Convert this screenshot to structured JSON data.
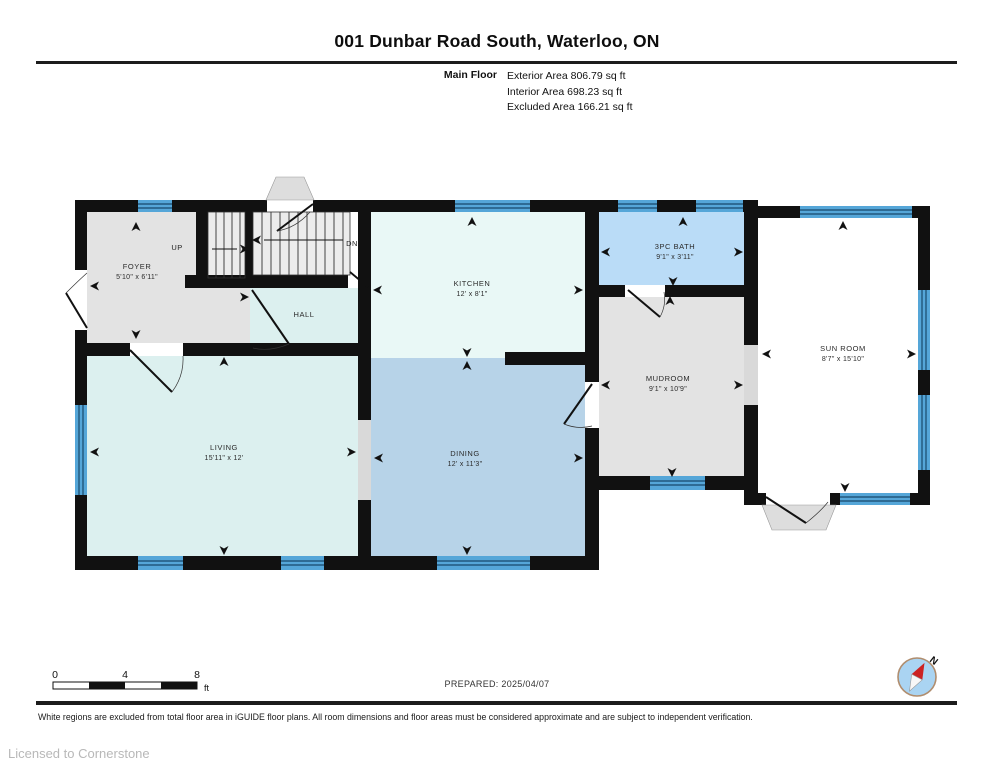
{
  "header": {
    "title": "001 Dunbar Road South, Waterloo, ON",
    "floor_label": "Main Floor",
    "area_lines": [
      "Exterior Area 806.79 sq ft",
      "Interior Area 698.23 sq ft",
      "Excluded Area 166.21 sq ft"
    ]
  },
  "rooms": {
    "foyer": {
      "name": "FOYER",
      "dims": "5'10\" x 6'11\""
    },
    "hall": {
      "name": "HALL",
      "dims": ""
    },
    "kitchen": {
      "name": "KITCHEN",
      "dims": "12' x 8'1\""
    },
    "bath": {
      "name": "3PC BATH",
      "dims": "9'1\" x 3'11\""
    },
    "mudroom": {
      "name": "MUDROOM",
      "dims": "9'1\" x 10'9\""
    },
    "sunroom": {
      "name": "SUN ROOM",
      "dims": "8'7\" x 15'10\""
    },
    "living": {
      "name": "LIVING",
      "dims": "15'11\" x 12'"
    },
    "dining": {
      "name": "DINING",
      "dims": "12' x 11'3\""
    }
  },
  "stairs": {
    "up_label": "UP",
    "down_label": "DN"
  },
  "scale_bar": {
    "tick_0": "0",
    "tick_4": "4",
    "tick_8": "8",
    "unit": "ft"
  },
  "compass": {
    "north_label": "N"
  },
  "footer": {
    "prepared": "PREPARED: 2025/04/07",
    "disclaimer": "White regions are excluded from total floor area in iGUIDE floor plans. All room dimensions and floor areas must be considered approximate and are subject to independent verification.",
    "license": "Licensed to Cornerstone"
  },
  "colors": {
    "wall": "#111111",
    "window_blue": "#55a6d8",
    "window_line": "#17486b",
    "room_gray": "#e3e3e3",
    "room_pale_cyan": "#dcf0ef",
    "room_light_cyan": "#e9f8f6",
    "room_bath_blue": "#badcf7",
    "room_dining_blue": "#b7d3e8",
    "stair_gray": "#ececec",
    "open_gray": "#d9d9d9",
    "compass_fill": "#aad4f2",
    "compass_ring": "#b08d6e",
    "needle_red": "#cc2222"
  }
}
